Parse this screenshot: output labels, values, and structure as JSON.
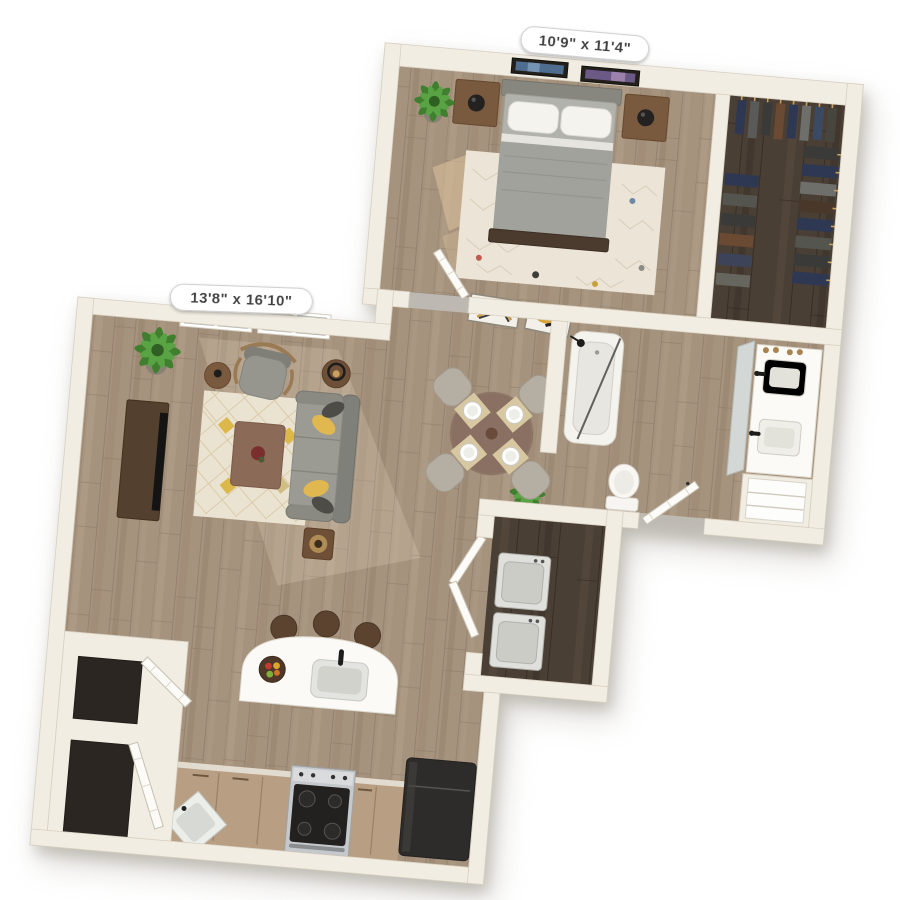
{
  "page": {
    "type": "3D apartment floor plan rendering (top-down dollhouse view)",
    "background": "#ffffff"
  },
  "labels": {
    "bedroom_dimensions": "10'9\" x 11'4\"",
    "living_room_dimensions": "13'8\" x 16'10\""
  },
  "rooms": [
    {
      "name": "Bedroom",
      "dimensions": "10'9\" x 11'4\"",
      "contents": [
        "queen bed with gray bedding and white pillows",
        "two wood nightstands with black lamps",
        "two framed artworks on wall",
        "cream patterned area rug",
        "potted plant",
        "door to hallway"
      ]
    },
    {
      "name": "Walk-in closet",
      "contents": [
        "hanging clothes on three rails",
        "dark wood floor"
      ]
    },
    {
      "name": "Bathroom",
      "contents": [
        "bathtub with shower",
        "double-sink vanity with leaning mirror",
        "toilet",
        "linen shelves",
        "entry door"
      ]
    },
    {
      "name": "Living room",
      "dimensions": "13'8\" x 16'10\"",
      "contents": [
        "two double windows",
        "media console with TV",
        "gray armchair with rattan arms",
        "round side table",
        "gray sofa with yellow and charcoal pillows",
        "two lamp side tables",
        "coffee table with decor",
        "cream diamond-pattern rug",
        "potted plant"
      ]
    },
    {
      "name": "Dining area",
      "contents": [
        "round table with centerpiece",
        "four upholstered chairs",
        "four place settings"
      ]
    },
    {
      "name": "Kitchen",
      "contents": [
        "white island with sink, faucet and fruit bowl",
        "three bar stools",
        "stainless range with four burners",
        "dark refrigerator",
        "corner sink",
        "wood base cabinets",
        "two storage closets with open doors"
      ]
    },
    {
      "name": "Laundry closet",
      "contents": [
        "washer",
        "dryer",
        "open bifold doors"
      ]
    },
    {
      "name": "Hallway",
      "contents": [
        "two framed artworks",
        "potted plant"
      ]
    }
  ],
  "colors": {
    "wall": "#f2ede3",
    "wood_floor": "#a6937e",
    "dark_floor": "#4a3f35",
    "label_background": "#ffffff",
    "label_text": "#3f3f3f",
    "sofa_gray": "#94948c",
    "accent_pillow_yellow": "#e0b84f",
    "rug_cream": "#ece5d6",
    "plant_green": "#4a8a35",
    "furniture_wood": "#6e4f37"
  }
}
